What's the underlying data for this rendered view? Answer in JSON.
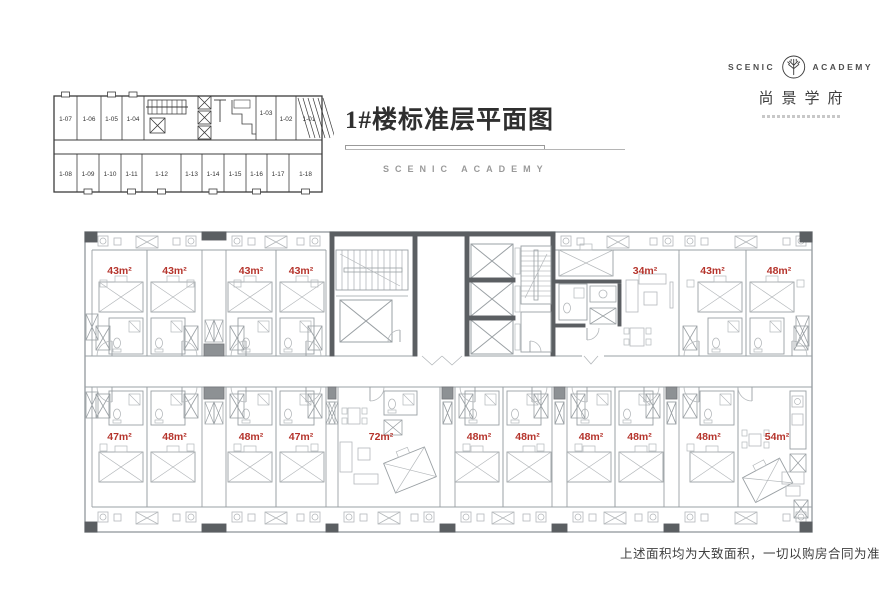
{
  "header": {
    "title": "1#楼标准层平面图",
    "subtitle": "SCENIC ACADEMY"
  },
  "logo": {
    "en_left": "SCENIC",
    "en_right": "ACADEMY",
    "cn": "尚景学府"
  },
  "keyplan": {
    "top_units": [
      "1-07",
      "1-06",
      "1-05",
      "1-04",
      "1-03",
      "1-02",
      "1-01"
    ],
    "bottom_units": [
      "1-08",
      "1-09",
      "1-10",
      "1-11",
      "1-12",
      "1-13",
      "1-14",
      "1-15",
      "1-16",
      "1-17",
      "1-18"
    ]
  },
  "floorplan": {
    "top_rooms": [
      "43m²",
      "43m²",
      "43m²",
      "43m²",
      "34m²",
      "43m²",
      "48m²"
    ],
    "bottom_rooms": [
      "47m²",
      "48m²",
      "48m²",
      "47m²",
      "72m²",
      "48m²",
      "48m²",
      "48m²",
      "48m²",
      "48m²",
      "54m²"
    ]
  },
  "footer": {
    "disclaimer": "上述面积均为大致面积，一切以购房合同为准"
  },
  "colors": {
    "area_label": "#b5342c",
    "wall": "#9aa0a4",
    "wall_dark": "#5b5f62",
    "furniture": "#b4b8bb",
    "keyline": "#3c3c3c"
  }
}
